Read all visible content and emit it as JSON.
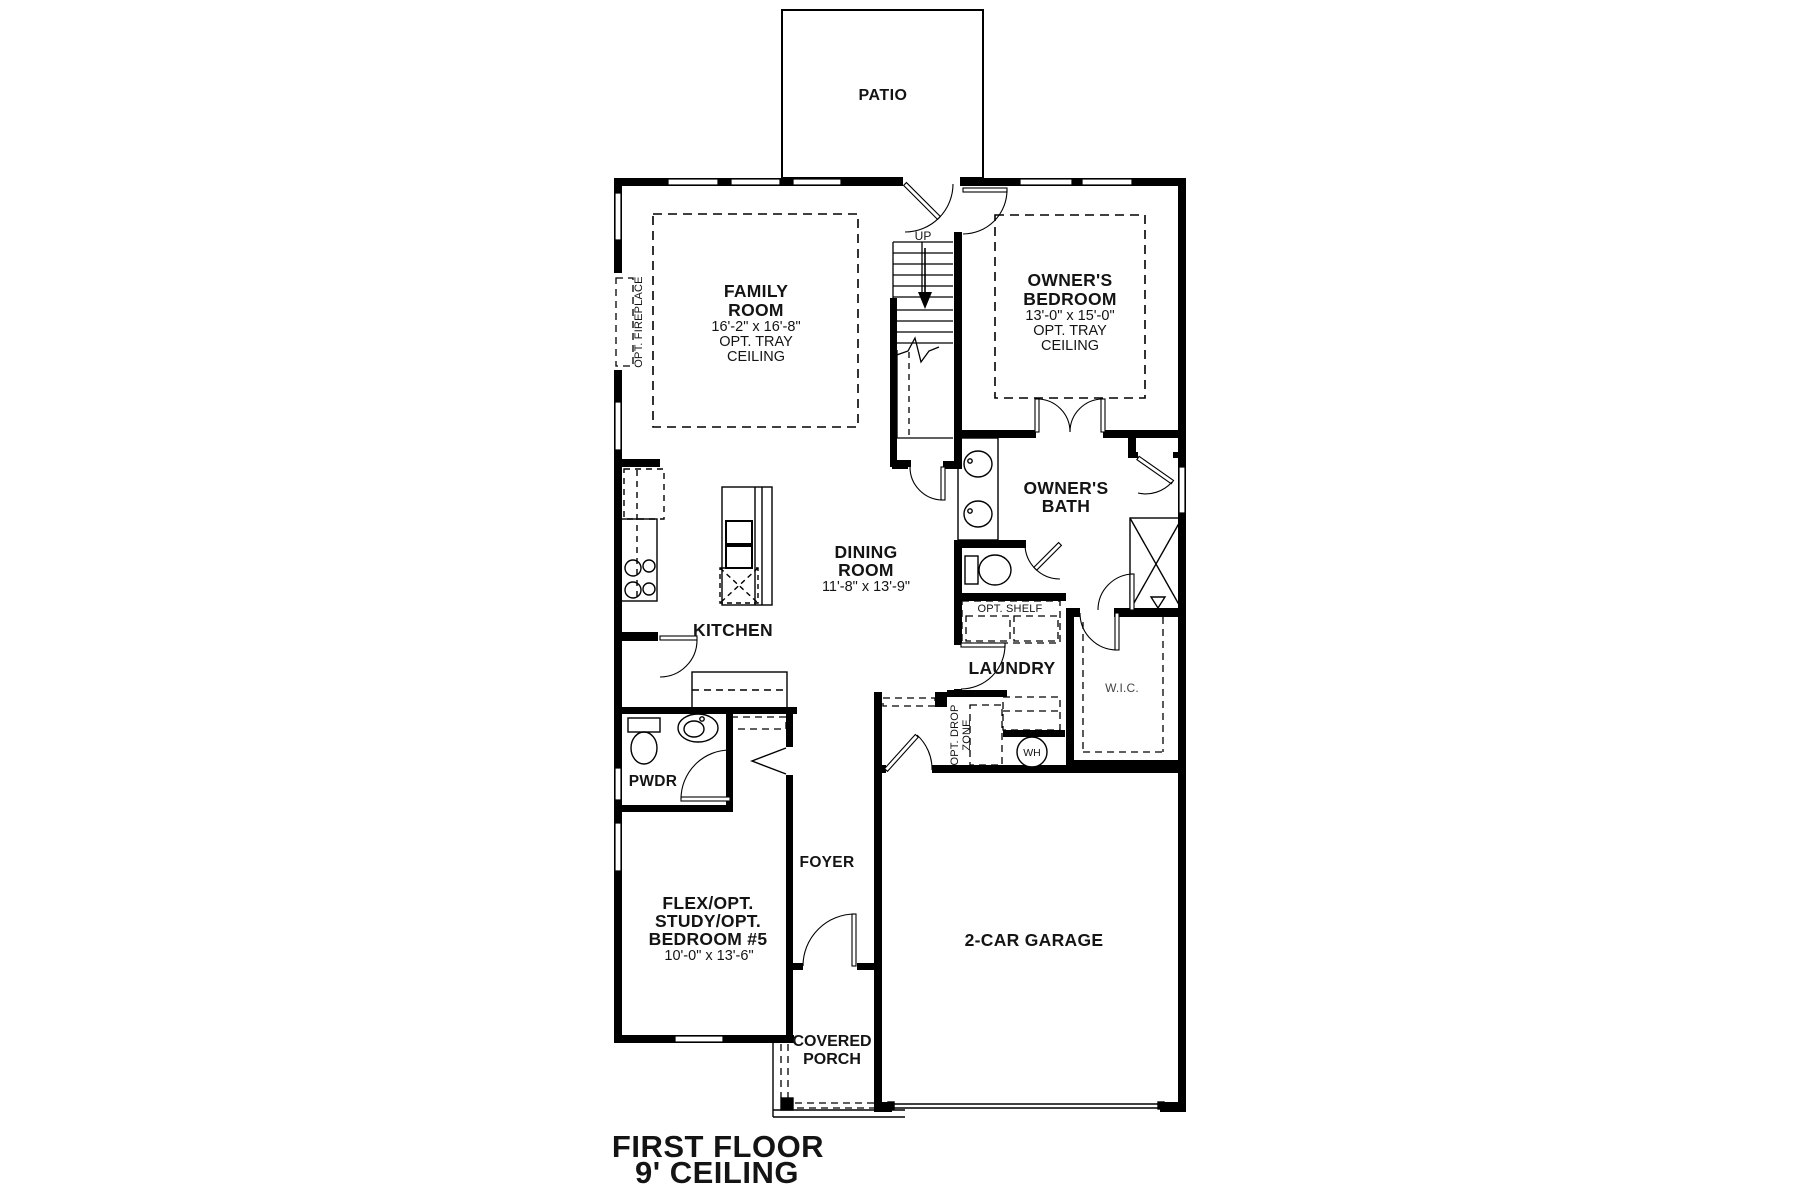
{
  "title": {
    "line1": "FIRST FLOOR",
    "line2": "9' CEILING"
  },
  "rooms": {
    "patio": {
      "label": "PATIO"
    },
    "family_room": {
      "l1": "FAMILY",
      "l2": "ROOM",
      "dims": "16'-2\" x 16'-8\"",
      "n1": "OPT. TRAY",
      "n2": "CEILING"
    },
    "owners_bedroom": {
      "l1": "OWNER'S",
      "l2": "BEDROOM",
      "dims": "13'-0\" x 15'-0\"",
      "n1": "OPT. TRAY",
      "n2": "CEILING"
    },
    "owners_bath": {
      "l1": "OWNER'S",
      "l2": "BATH"
    },
    "dining_room": {
      "l1": "DINING",
      "l2": "ROOM",
      "dims": "11'-8\" x 13'-9\""
    },
    "kitchen": {
      "label": "KITCHEN"
    },
    "laundry": {
      "label": "LAUNDRY"
    },
    "wic": {
      "label": "W.I.C."
    },
    "pwdr": {
      "label": "PWDR"
    },
    "foyer": {
      "label": "FOYER"
    },
    "flex": {
      "l1": "FLEX/OPT.",
      "l2": "STUDY/OPT.",
      "l3": "BEDROOM #5",
      "dims": "10'-0\" x 13'-6\""
    },
    "garage": {
      "label": "2-CAR GARAGE"
    },
    "covered_porch": {
      "l1": "COVERED",
      "l2": "PORCH"
    }
  },
  "annotations": {
    "up": "UP",
    "opt_fireplace": "OPT. FIREPLACE",
    "opt_shelf": "OPT. SHELF",
    "opt_drop_l1": "OPT. DROP",
    "opt_drop_l2": "ZONE",
    "wh": "WH"
  },
  "colors": {
    "wall": "#000000",
    "background": "#ffffff",
    "text": "#141414"
  }
}
